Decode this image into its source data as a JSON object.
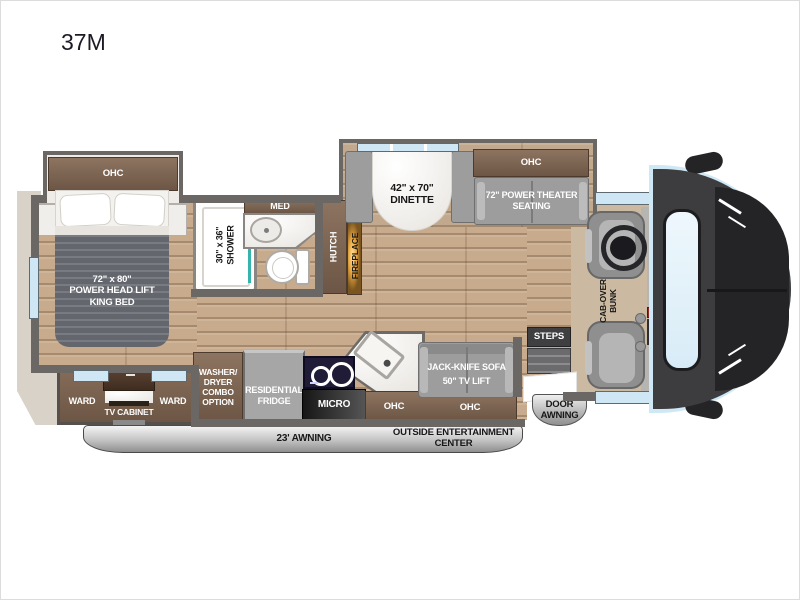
{
  "title": "37M",
  "colors": {
    "wall_gray": "#6b6764",
    "wood_floor": "#c7ab8c",
    "cabinet_brown": "#7a614f",
    "furniture_gray": "#9d9d9d",
    "window_blue": "#cfe6f4",
    "marble_white": "#f2f0ec",
    "bed_blanket_gray": "#6e7178",
    "awning_silver": "#c9c9c9",
    "fireplace_glow_orange": "#e8a33c",
    "shower_accent_teal": "#35b4ae",
    "front_cap_dark": "#3a3a3c",
    "windshield_blue": "#dff0f9"
  },
  "labels": {
    "ohc": "OHC",
    "bed_line1": "72\" x 80\"",
    "bed_line2": "POWER HEAD LIFT",
    "bed_line3": "KING BED",
    "shower_line1": "30\" x 36\"",
    "shower_line2": "SHOWER",
    "med": "MED",
    "hutch": "HUTCH",
    "fireplace": "FIREPLACE",
    "dinette_line1": "42\" x 70\"",
    "dinette_line2": "DINETTE",
    "theater_line1": "72\" POWER THEATER",
    "theater_line2": "SEATING",
    "cabover_line1": "CAB-OVER",
    "cabover_line2": "BUNK",
    "ward": "WARD",
    "tv_cabinet": "TV CABINET",
    "washer_line1": "WASHER/",
    "washer_line2": "DRYER",
    "washer_line3": "COMBO",
    "washer_line4": "OPTION",
    "fridge_line1": "RESIDENTIAL",
    "fridge_line2": "FRIDGE",
    "micro": "MICRO",
    "sofa_line1": "JACK-KNIFE SOFA",
    "sofa_line2": "50\" TV LIFT",
    "steps": "STEPS",
    "door_awning_line1": "DOOR",
    "door_awning_line2": "AWNING",
    "main_awning": "23' AWNING",
    "outside_line1": "OUTSIDE ENTERTAINMENT",
    "outside_line2": "CENTER"
  }
}
